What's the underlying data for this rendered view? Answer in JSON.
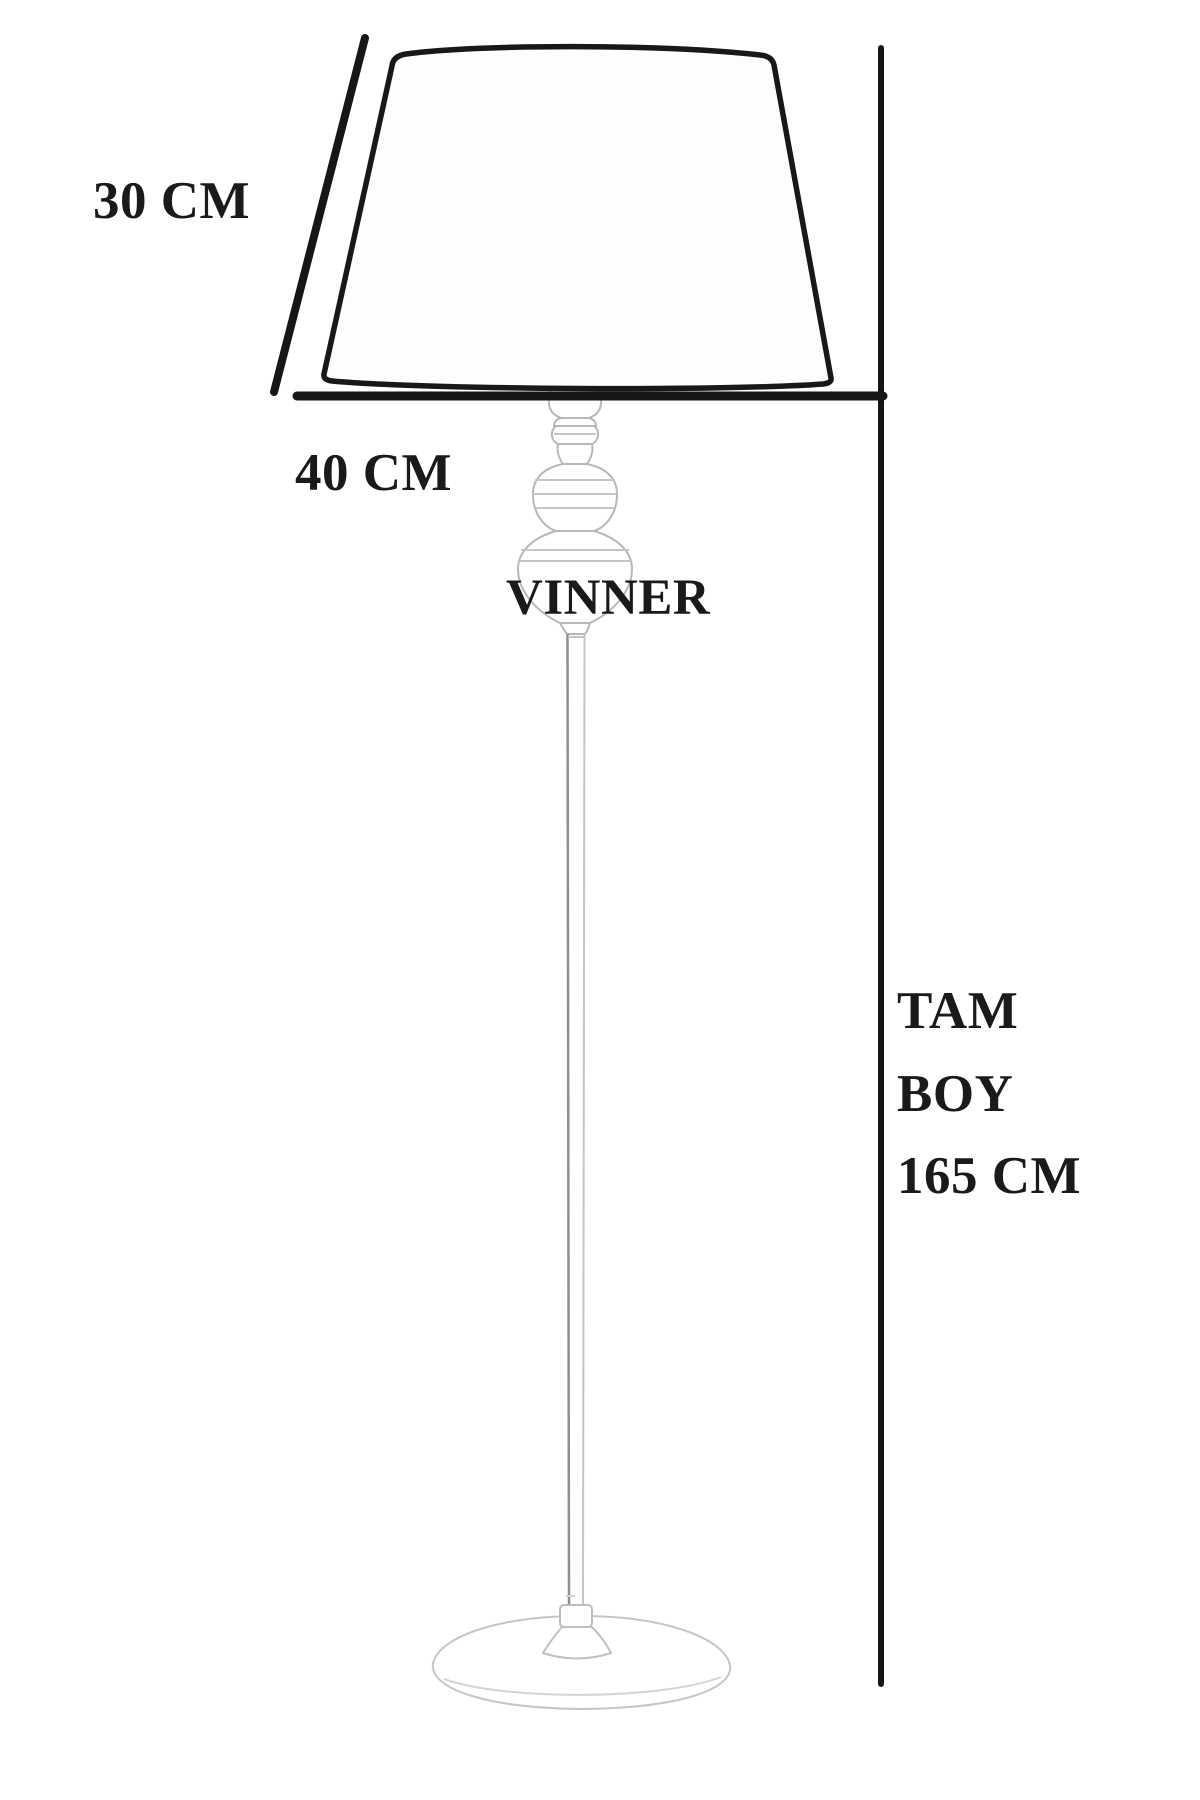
{
  "brand": {
    "label": "VINNER"
  },
  "dimensions": {
    "shade_slant_height": {
      "label": "30 CM"
    },
    "shade_diameter": {
      "label": "40 CM"
    },
    "total_height": {
      "lines": [
        "TAM",
        "BOY",
        "165 CM"
      ]
    }
  },
  "colors": {
    "outline": "#181818",
    "sketch_light": "#b8b8b8",
    "sketch_lighter": "#cccccc",
    "text": "#1a1a1a",
    "background": "#ffffff"
  }
}
